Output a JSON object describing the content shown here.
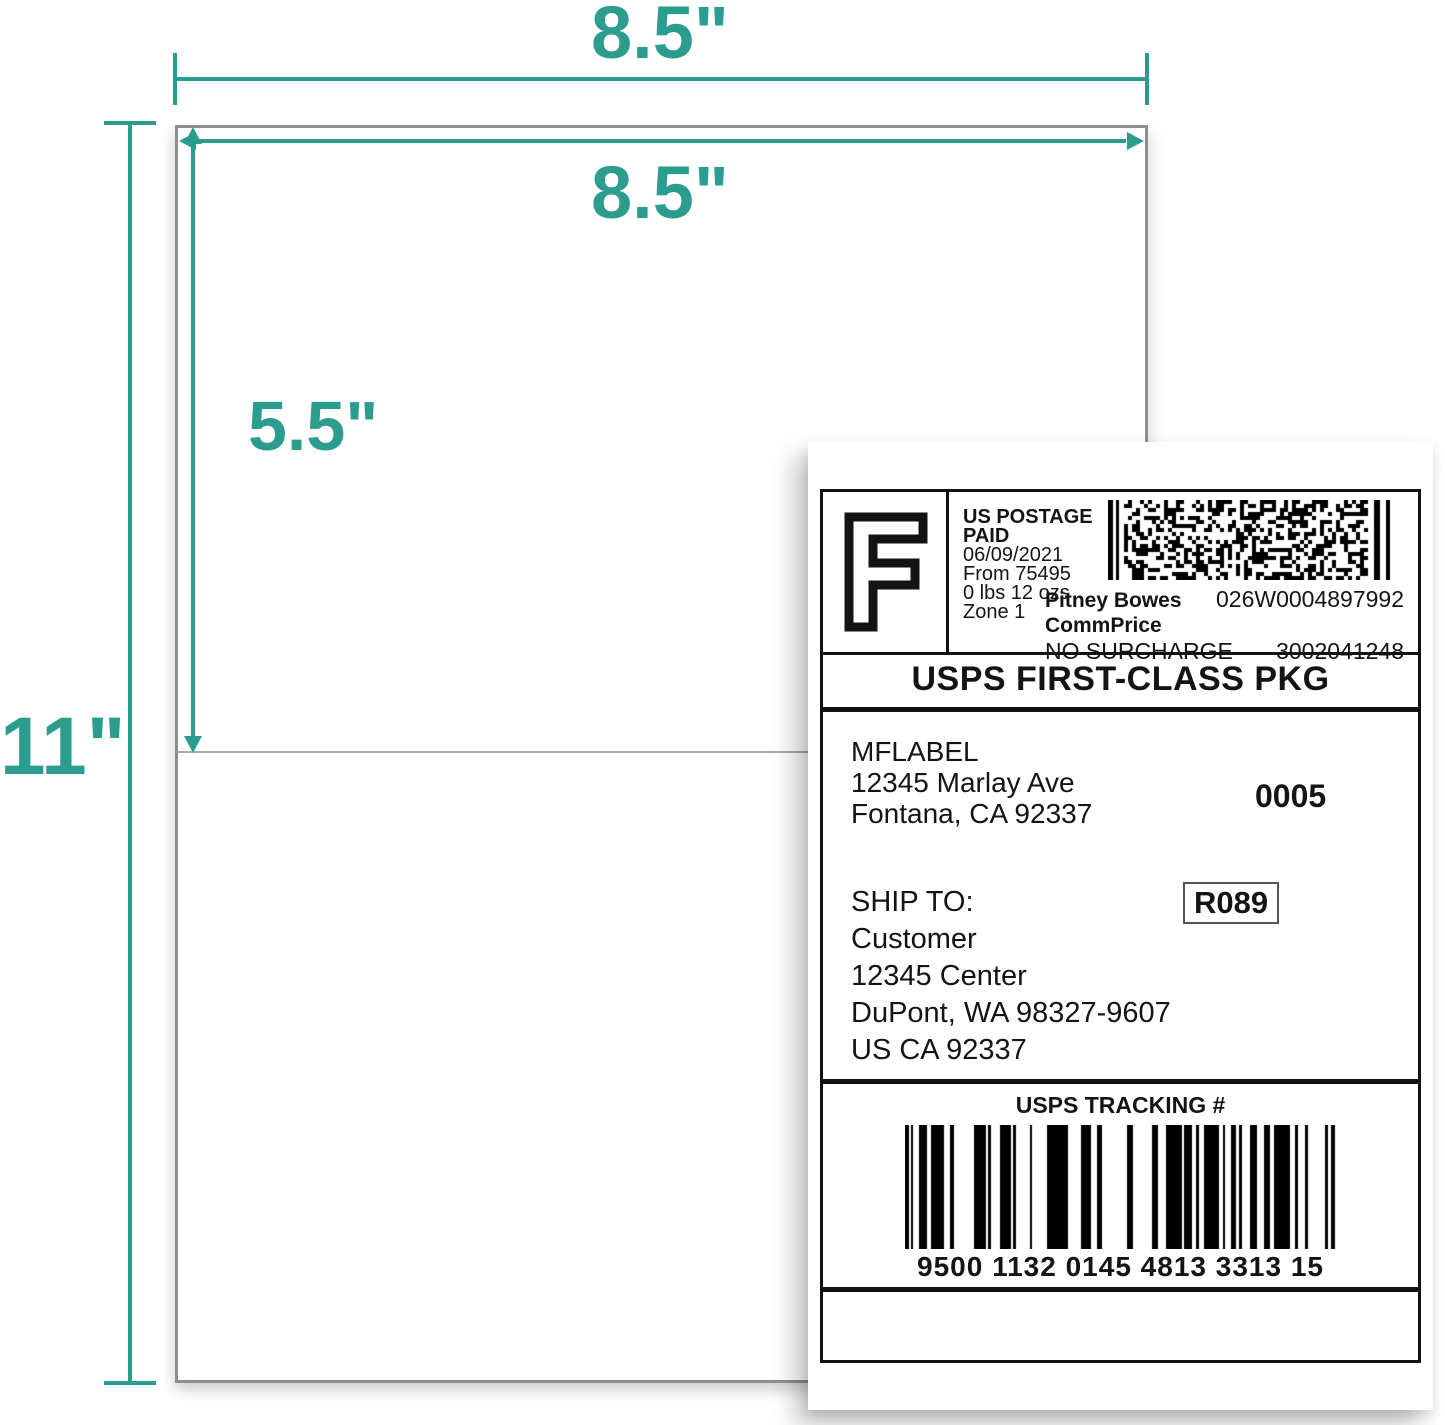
{
  "dimensions": {
    "sheet_width": "8.5\"",
    "label_width": "8.5\"",
    "label_height": "5.5\"",
    "sheet_height": "11\"",
    "accent_color": "#2a9d8f"
  },
  "shipping_label": {
    "postage_mark": "F",
    "meter": {
      "lines": [
        "US POSTAGE",
        "PAID",
        "06/09/2021",
        "From 75495",
        "0 lbs 12 ozs",
        "Zone 1"
      ],
      "carrier": "Pitney Bowes",
      "meter_id": "026W0004897992",
      "rate": "CommPrice",
      "surcharge": "NO SURCHARGE",
      "account": "3002041248"
    },
    "service": "USPS FIRST-CLASS PKG",
    "from": {
      "name": "MFLABEL",
      "street": "12345 Marlay Ave",
      "city_state_zip": "Fontana, CA 92337"
    },
    "batch": "0005",
    "ship_to_heading": "SHIP TO:",
    "to": {
      "name": "Customer",
      "street": "12345 Center",
      "city_state_zip": "DuPont, WA 98327-9607",
      "country_line": "US CA 92337"
    },
    "routing": "R089",
    "tracking_heading": "USPS TRACKING #",
    "tracking_number": "9500 1132 0145 4813 3313 15"
  }
}
